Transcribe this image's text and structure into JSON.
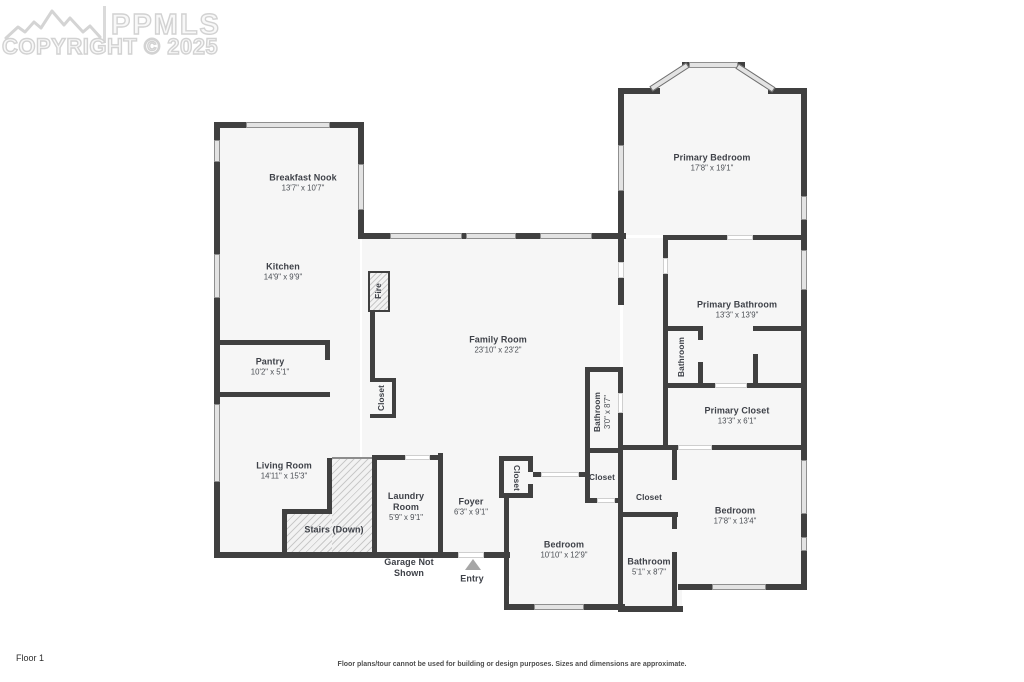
{
  "watermark": {
    "brand": "PPMLS",
    "copyright": "COPYRIGHT © 2025",
    "logo": "mountain-logo"
  },
  "floor_label": "Floor 1",
  "disclaimer": "Floor plans/tour cannot be used for building or design purposes. Sizes and dimensions are approximate.",
  "annotations": {
    "garage": "Garage Not Shown",
    "entry": "Entry"
  },
  "rooms": {
    "breakfast_nook": {
      "name": "Breakfast Nook",
      "dims": "13'7\" x 10'7\""
    },
    "kitchen": {
      "name": "Kitchen",
      "dims": "14'9\" x 9'9\""
    },
    "pantry": {
      "name": "Pantry",
      "dims": "10'2\" x 5'1\""
    },
    "living_room": {
      "name": "Living Room",
      "dims": "14'11\" x 15'3\""
    },
    "family_room": {
      "name": "Family Room",
      "dims": "23'10\" x 23'2\""
    },
    "stairs": {
      "name": "Stairs (Down)"
    },
    "laundry_room": {
      "name": "Laundry Room",
      "dims": "5'9\" x 9'1\""
    },
    "foyer": {
      "name": "Foyer",
      "dims": "6'3\" x 9'1\""
    },
    "primary_bedroom": {
      "name": "Primary Bedroom",
      "dims": "17'8\" x 19'1\""
    },
    "primary_bathroom": {
      "name": "Primary Bathroom",
      "dims": "13'3\" x 13'9\""
    },
    "primary_toilet": {
      "name": "Bathroom"
    },
    "primary_closet": {
      "name": "Primary Closet",
      "dims": "13'3\" x 6'1\""
    },
    "hall_bathroom": {
      "name": "Bathroom",
      "dims": "3'0\" x 8'7\""
    },
    "bedroom_mid": {
      "name": "Bedroom",
      "dims": "10'10\" x 12'9\""
    },
    "bedroom_right": {
      "name": "Bedroom",
      "dims": "17'8\" x 13'4\""
    },
    "bathroom_right": {
      "name": "Bathroom",
      "dims": "5'1\" x 8'7\""
    },
    "fireplace": {
      "name": "Fire"
    },
    "closet_kitchen": {
      "name": "Closet"
    },
    "closet_foyer": {
      "name": "Closet"
    },
    "closet_hall": {
      "name": "Closet"
    },
    "closet_bedroom_right": {
      "name": "Closet"
    }
  },
  "colors": {
    "wall": "#404040",
    "room_fill": "#f6f6f6",
    "window": "#e3e3e3",
    "label": "#3e4148",
    "watermark": "#d2d2d2"
  }
}
